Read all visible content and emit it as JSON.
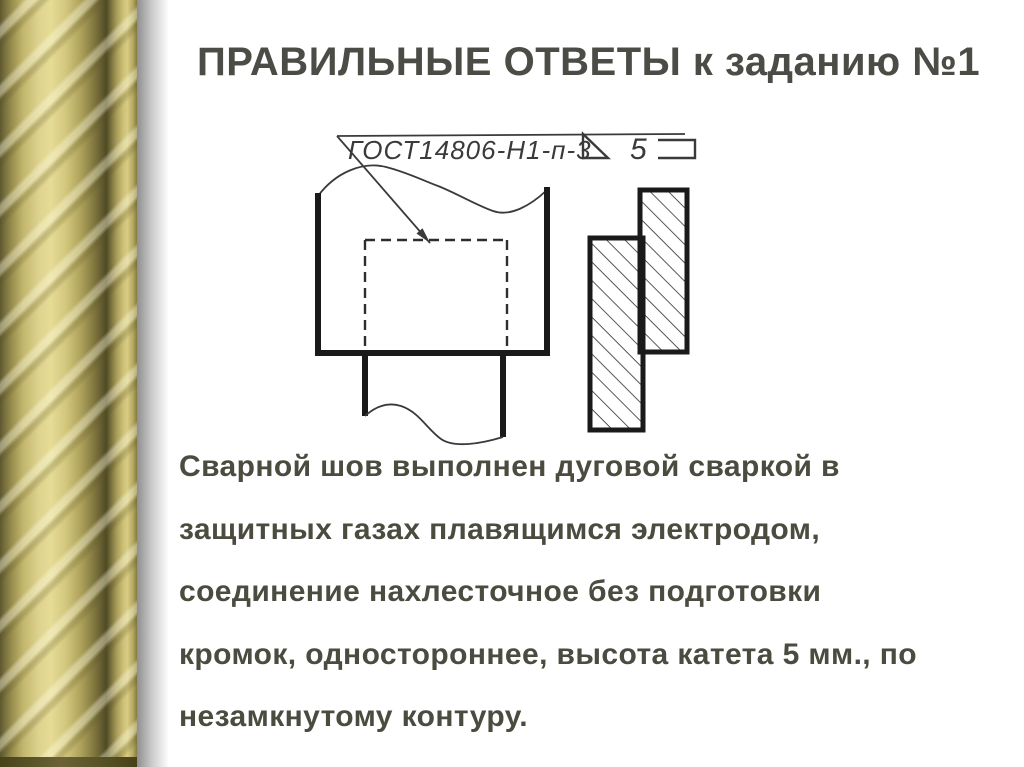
{
  "slide": {
    "title": "ПРАВИЛЬНЫЕ ОТВЕТЫ к заданию №1",
    "body_lines": [
      "Сварной шов выполнен дуговой сваркой в",
      "защитных газах плавящимся электродом,",
      "соединение нахлесточное без подготовки",
      "кромок, одностороннее, высота катета 5 мм., по",
      "незамкнутому контуру."
    ]
  },
  "drawing": {
    "weld_designation": "ГОСТ14806-Н1-п-3",
    "fillet_leg_size": "5",
    "symbols": {
      "fillet_weld_symbol": "right-triangle",
      "open_contour_symbol": "open-rectangle"
    },
    "views": [
      "front-view-lap-joint",
      "section-view-hatched"
    ]
  },
  "colors": {
    "text": "#4b4b40",
    "line_thin": "#3a3a3a",
    "line_thick": "#1a1a1a",
    "border_gold_light": "#e6dc96",
    "border_gold_dark": "#5e5830",
    "shadow_gray": "#8f8f8f"
  }
}
